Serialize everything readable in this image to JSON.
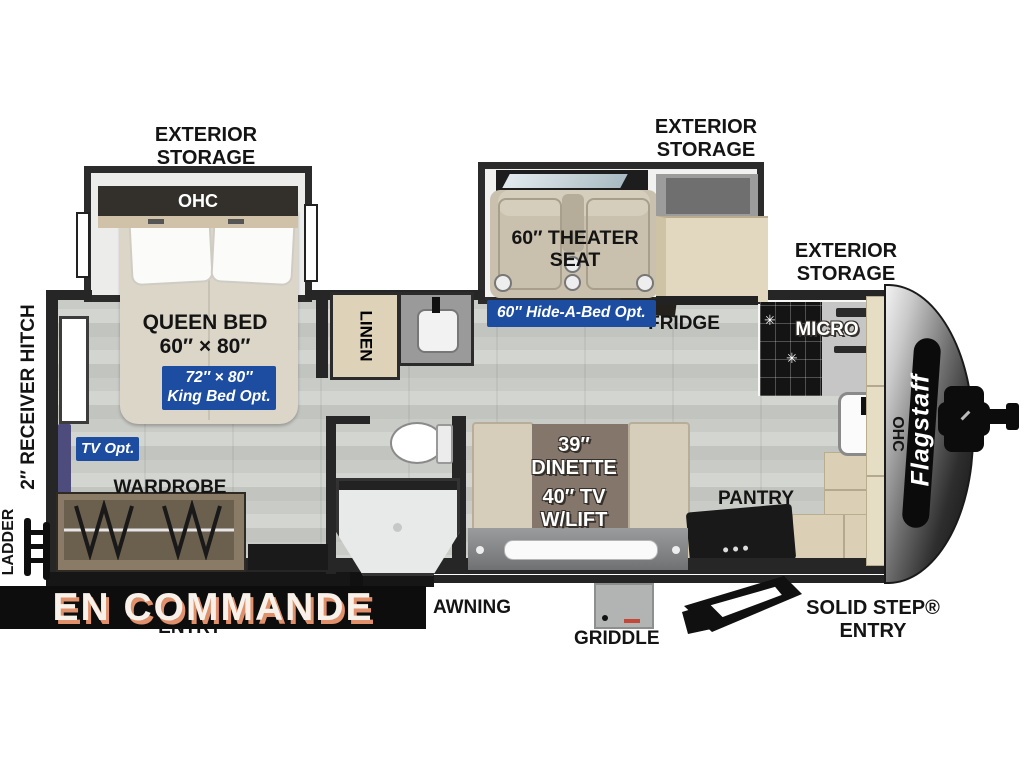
{
  "brand": {
    "logo": "Flagstaff"
  },
  "banner": {
    "label": "EN COMMANDE"
  },
  "storage": {
    "bedroom": "EXTERIOR STORAGE",
    "theater": "EXTERIOR STORAGE",
    "front": "EXTERIOR STORAGE"
  },
  "bedroom": {
    "ohc": "OHC",
    "bed_title": "QUEEN BED",
    "bed_size": "60″ × 80″",
    "king_opt": "72″ × 80″ King Bed Opt.",
    "tv_opt": "TV Opt.",
    "wardrobe": "WARDROBE"
  },
  "bath": {
    "linen": "LINEN"
  },
  "living": {
    "theater_seat": "60″ THEATER SEAT",
    "hide_a_bed": "60″ Hide-A-Bed Opt.",
    "dinette": "39″ DINETTE",
    "tv_lift": "40″ TV W/LIFT"
  },
  "kitchen": {
    "fridge": "FRIDGE",
    "micro": "MICRO",
    "pantry": "PANTRY",
    "ohc": "OHC"
  },
  "exterior": {
    "hitch": "2″ RECEIVER HITCH",
    "ladder": "LADDER",
    "rear_entry": "ENTRY",
    "awning": "AWNING",
    "griddle": "GRIDDLE",
    "solid_step": "SOLID STEP® ENTRY"
  },
  "colors": {
    "accent_blue": "#1c4da0",
    "banner_bg": "#0d0d0d",
    "banner_shadow": "#e0906a",
    "wall": "#262626",
    "floor_gray": "#c9cbc6"
  }
}
